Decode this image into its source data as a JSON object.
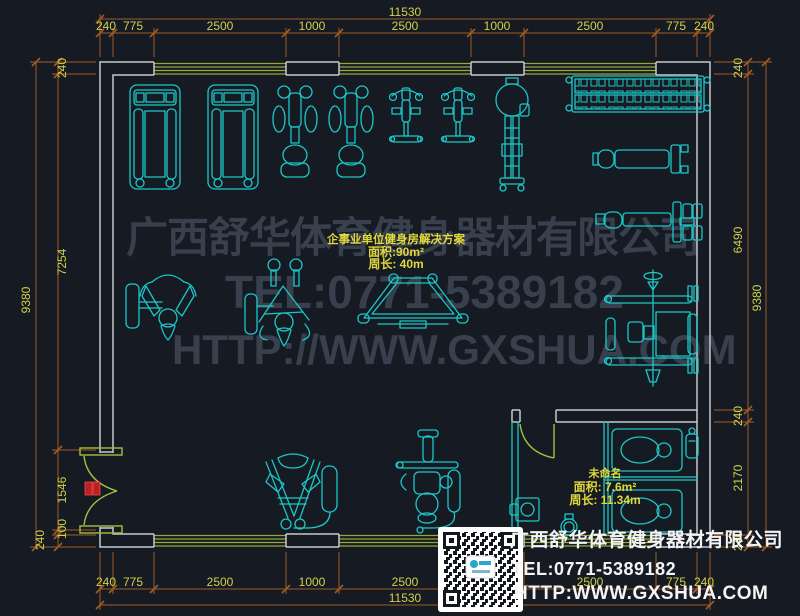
{
  "colors": {
    "background": "#151a23",
    "equipment": "#1cc7c7",
    "wall": "#c6cacd",
    "window": "#97a837",
    "door": "#9cc43e",
    "handle": "#b92222",
    "dimension_line": "#a15c24",
    "dimension_text": "#d2d24a",
    "label_text": "#e0d83c",
    "watermark": "#3a4150"
  },
  "dimensions": {
    "top": {
      "overall": "11530",
      "segments": [
        "240",
        "775",
        "2500",
        "1000",
        "2500",
        "1000",
        "2500",
        "775",
        "240"
      ]
    },
    "bottom": {
      "overall": "11530",
      "segments": [
        "240",
        "775",
        "2500",
        "1000",
        "2500",
        "1000",
        "2500",
        "775",
        "240"
      ]
    },
    "left": {
      "overall": "9380",
      "segments": [
        "240",
        "7254",
        "1546",
        "100",
        "240"
      ]
    },
    "right": {
      "overall": "9380",
      "segments": [
        "240",
        "6490",
        "240",
        "2170",
        "240"
      ]
    }
  },
  "main_room": {
    "title": "企事业单位健身房解决方案",
    "area": "面积:90m²",
    "perimeter": "周长: 40m"
  },
  "wc_room": {
    "name": "未命名",
    "area": "面积: 7.6m²",
    "perimeter": "周长: 11.34m"
  },
  "watermark": {
    "line1": "广西舒华体育健身器材有限公司",
    "line2": "TEL:0771-5389182",
    "line3": "HTTP://WWW.GXSHUA.COM"
  },
  "footer": {
    "company": "广西舒华体育健身器材有限公司",
    "tel": "TEL:0771-5389182",
    "website": "HTTP:WWW.GXSHUA.COM"
  }
}
